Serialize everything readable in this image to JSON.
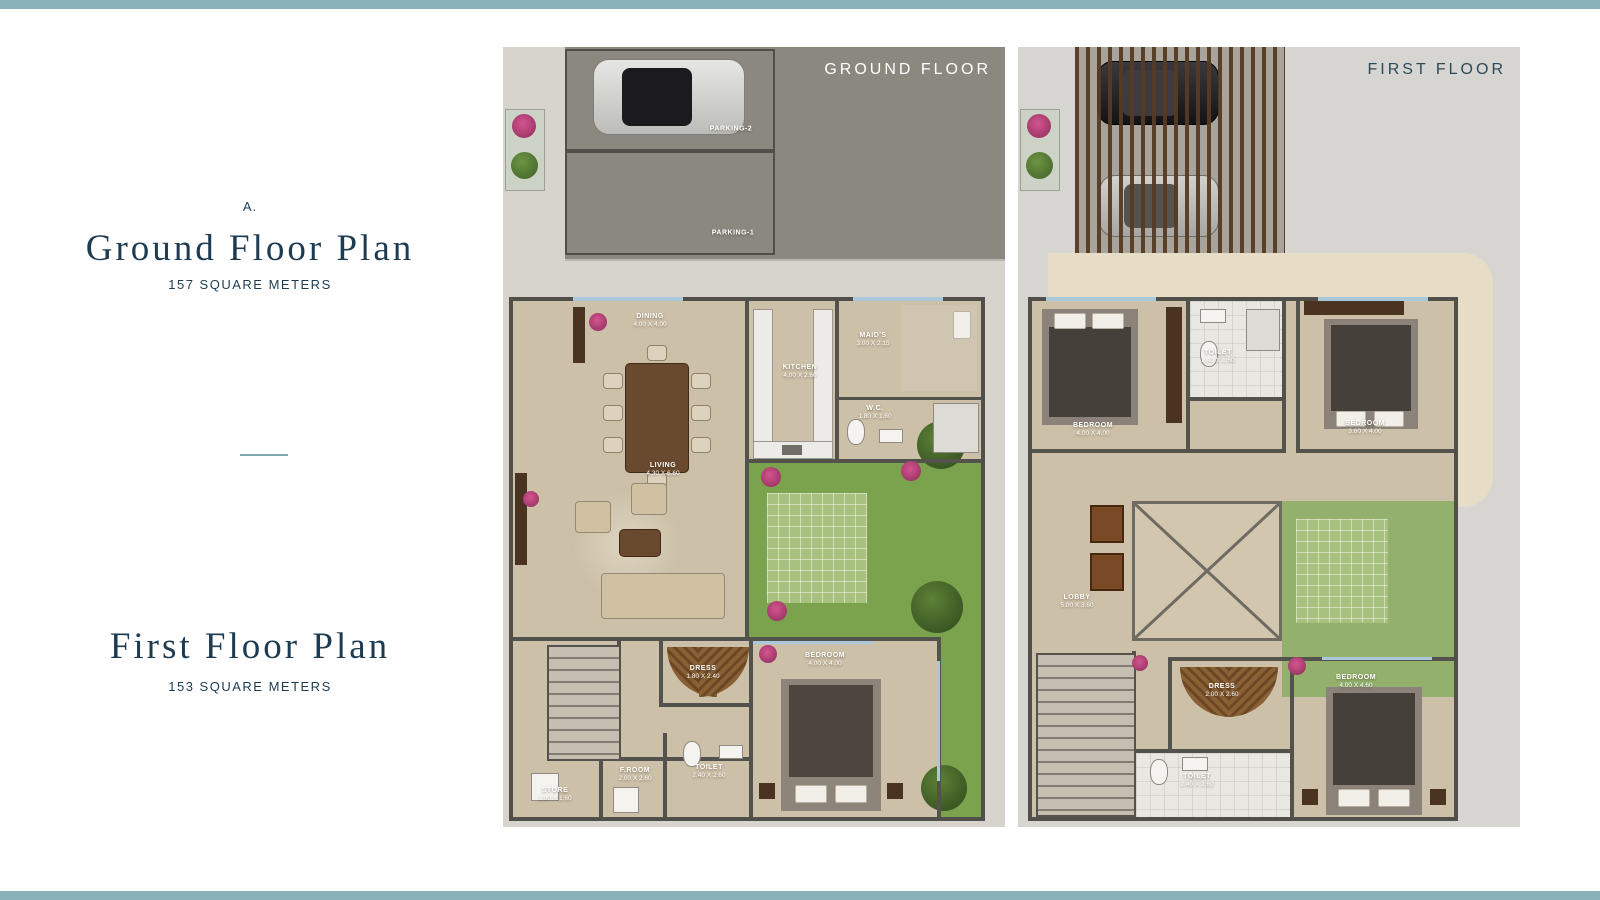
{
  "page": {
    "accent_color": "#8ab3b9",
    "title_color": "#1d3c52"
  },
  "left_panel": {
    "section_letter": "A.",
    "ground_title": "Ground Floor Plan",
    "ground_area": "157 SQUARE METERS",
    "first_title": "First Floor Plan",
    "first_area": "153 SQUARE METERS"
  },
  "ground_floor": {
    "header": "GROUND FLOOR",
    "parking": [
      {
        "label": "PARKING-2"
      },
      {
        "label": "PARKING-1"
      }
    ],
    "rooms": {
      "dining": {
        "name": "DINING",
        "dims": "4.00 X 4.00"
      },
      "kitchen": {
        "name": "KITCHEN",
        "dims": "4.00 X 2.60"
      },
      "maids": {
        "name": "MAID'S",
        "dims": "3.00 X 2.15"
      },
      "wc": {
        "name": "W.C.",
        "dims": "1.80 X 1.60"
      },
      "living": {
        "name": "LIVING",
        "dims": "4.30 X 6.60"
      },
      "dress": {
        "name": "DRESS",
        "dims": "1.80 X 2.40"
      },
      "bedroom": {
        "name": "BEDROOM",
        "dims": "4.00 X 4.00"
      },
      "froom": {
        "name": "F.ROOM",
        "dims": "2.00 X 2.60"
      },
      "toilet": {
        "name": "TOILET",
        "dims": "2.40 X 2.60"
      },
      "store": {
        "name": "STORE",
        "dims": "1.90 X 1.60"
      }
    }
  },
  "first_floor": {
    "header": "FIRST FLOOR",
    "rooms": {
      "bedroom1": {
        "name": "BEDROOM",
        "dims": "4.00 X 4.00"
      },
      "toilet1": {
        "name": "TOILET",
        "dims": "2.40 X 1.60"
      },
      "bedroom2": {
        "name": "BEDROOM",
        "dims": "3.60 X 4.00"
      },
      "lobby": {
        "name": "LOBBY",
        "dims": "5.00 X 3.60"
      },
      "dress": {
        "name": "DRESS",
        "dims": "2.00 X 2.60"
      },
      "bedroom3": {
        "name": "BEDROOM",
        "dims": "4.00 X 4.60"
      },
      "toilet2": {
        "name": "TOILET",
        "dims": "2.40 X 2.60"
      }
    }
  }
}
